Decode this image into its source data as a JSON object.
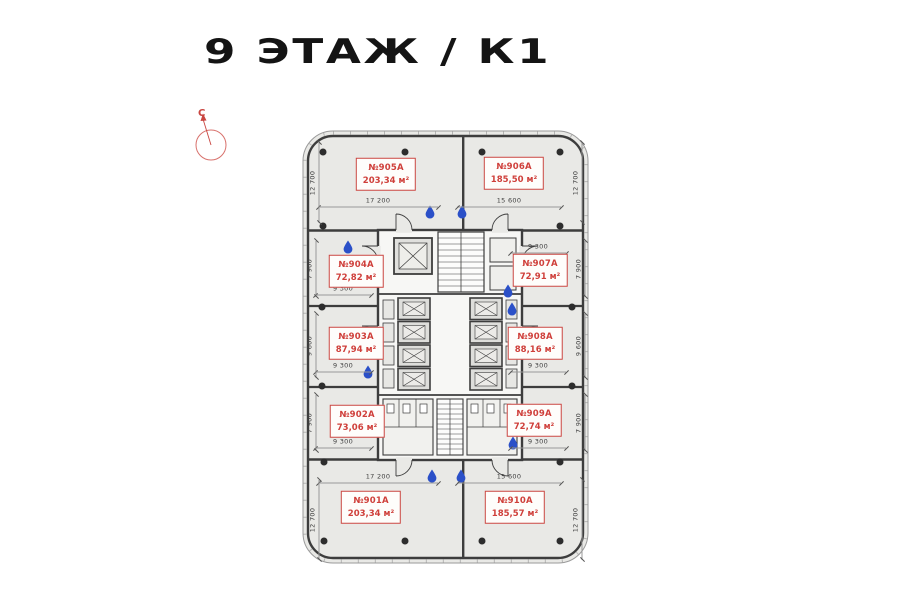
{
  "title": "9 ЭТАЖ / К1",
  "north": {
    "label": "С"
  },
  "colors": {
    "accent_red": "#c94540",
    "drop_blue": "#2b50c8",
    "wall_dark": "#3d3d3d",
    "floor_gray": "#e9e9e6",
    "dim_text": "#3f3f3f"
  },
  "plan": {
    "rooms": [
      {
        "number": "№905А",
        "area": "203,34 м²",
        "cx": 386,
        "cy": 174
      },
      {
        "number": "№906А",
        "area": "185,50 м²",
        "cx": 514,
        "cy": 173
      },
      {
        "number": "№904А",
        "area": "72,82 м²",
        "cx": 356,
        "cy": 271
      },
      {
        "number": "№907А",
        "area": "72,91 м²",
        "cx": 540,
        "cy": 270
      },
      {
        "number": "№903А",
        "area": "87,94 м²",
        "cx": 356,
        "cy": 343
      },
      {
        "number": "№908А",
        "area": "88,16 м²",
        "cx": 535,
        "cy": 343
      },
      {
        "number": "№902А",
        "area": "73,06 м²",
        "cx": 357,
        "cy": 421
      },
      {
        "number": "№909А",
        "area": "72,74 м²",
        "cx": 534,
        "cy": 420
      },
      {
        "number": "№901А",
        "area": "203,34 м²",
        "cx": 371,
        "cy": 507
      },
      {
        "number": "№910А",
        "area": "185,57 м²",
        "cx": 515,
        "cy": 507
      }
    ],
    "dimensions": [
      {
        "text": "17 200",
        "x": 378,
        "y": 202,
        "span": 120,
        "rot": false
      },
      {
        "text": "15 600",
        "x": 509,
        "y": 202,
        "span": 104,
        "rot": false
      },
      {
        "text": "9 300",
        "x": 343,
        "y": 290,
        "span": 56,
        "rot": false
      },
      {
        "text": "9 300",
        "x": 538,
        "y": 248,
        "span": 56,
        "rot": false
      },
      {
        "text": "9 300",
        "x": 343,
        "y": 367,
        "span": 56,
        "rot": false
      },
      {
        "text": "9 300",
        "x": 538,
        "y": 367,
        "span": 56,
        "rot": false
      },
      {
        "text": "9 300",
        "x": 343,
        "y": 443,
        "span": 56,
        "rot": false
      },
      {
        "text": "9 300",
        "x": 538,
        "y": 443,
        "span": 56,
        "rot": false
      },
      {
        "text": "17 200",
        "x": 378,
        "y": 478,
        "span": 120,
        "rot": false
      },
      {
        "text": "15 600",
        "x": 509,
        "y": 478,
        "span": 104,
        "rot": false
      },
      {
        "text": "12 700",
        "x": 314,
        "y": 183,
        "span": 80,
        "rot": true
      },
      {
        "text": "12 700",
        "x": 577,
        "y": 183,
        "span": 80,
        "rot": true
      },
      {
        "text": "7 900",
        "x": 311,
        "y": 269,
        "span": 56,
        "rot": true
      },
      {
        "text": "7 900",
        "x": 580,
        "y": 269,
        "span": 56,
        "rot": true
      },
      {
        "text": "9 600",
        "x": 311,
        "y": 346,
        "span": 64,
        "rot": true
      },
      {
        "text": "9 600",
        "x": 580,
        "y": 346,
        "span": 64,
        "rot": true
      },
      {
        "text": "7 900",
        "x": 311,
        "y": 423,
        "span": 56,
        "rot": true
      },
      {
        "text": "7 900",
        "x": 580,
        "y": 423,
        "span": 56,
        "rot": true
      },
      {
        "text": "12 700",
        "x": 314,
        "y": 520,
        "span": 80,
        "rot": true
      },
      {
        "text": "12 700",
        "x": 577,
        "y": 520,
        "span": 80,
        "rot": true
      }
    ],
    "water_drops": [
      {
        "x": 348,
        "y": 247
      },
      {
        "x": 430,
        "y": 212
      },
      {
        "x": 462,
        "y": 212
      },
      {
        "x": 508,
        "y": 291
      },
      {
        "x": 512,
        "y": 309
      },
      {
        "x": 368,
        "y": 372
      },
      {
        "x": 513,
        "y": 443
      },
      {
        "x": 432,
        "y": 476
      },
      {
        "x": 461,
        "y": 476
      }
    ],
    "columns": [
      {
        "x": 323,
        "y": 152
      },
      {
        "x": 405,
        "y": 152
      },
      {
        "x": 482,
        "y": 152
      },
      {
        "x": 560,
        "y": 152
      },
      {
        "x": 323,
        "y": 226
      },
      {
        "x": 560,
        "y": 226
      },
      {
        "x": 322,
        "y": 307
      },
      {
        "x": 572,
        "y": 307
      },
      {
        "x": 322,
        "y": 386
      },
      {
        "x": 572,
        "y": 386
      },
      {
        "x": 324,
        "y": 462
      },
      {
        "x": 560,
        "y": 462
      },
      {
        "x": 324,
        "y": 541
      },
      {
        "x": 405,
        "y": 541
      },
      {
        "x": 482,
        "y": 541
      },
      {
        "x": 560,
        "y": 541
      }
    ]
  }
}
